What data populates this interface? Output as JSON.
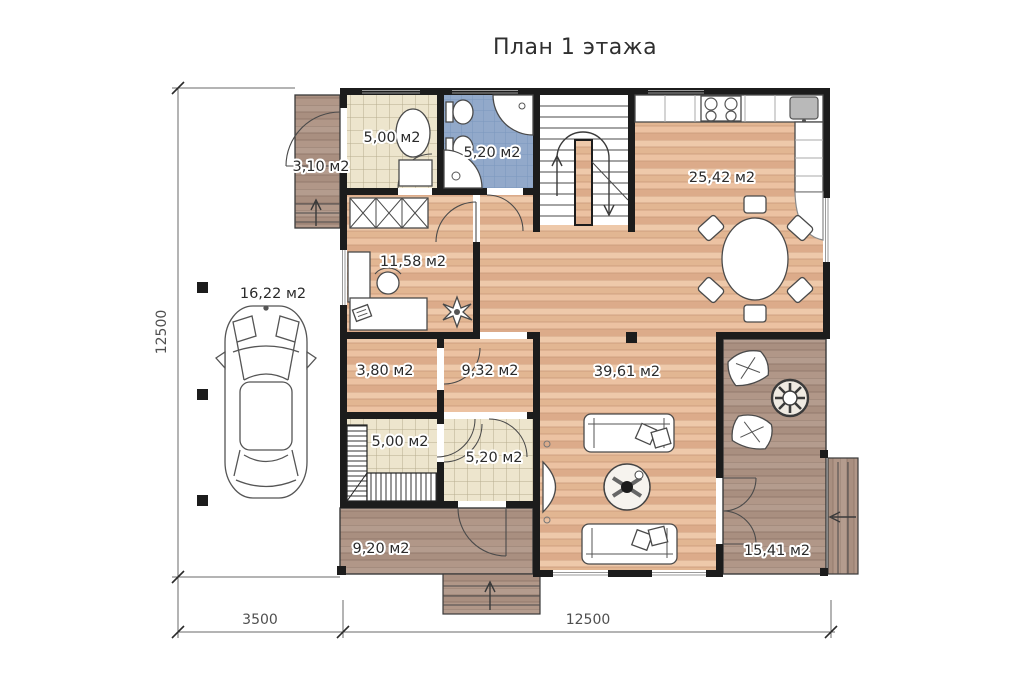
{
  "title": "План 1 этажа",
  "rooms": {
    "porch": "3,10 м2",
    "utility": "5,00 м2",
    "bathroom": "5,20 м2",
    "kitchen_dining": "25,42 м2",
    "office": "11,58 м2",
    "storage": "3,80 м2",
    "hallway": "9,32 м2",
    "boiler": "5,00 м2",
    "hall": "5,20 м2",
    "living": "39,61 м2",
    "terrace_back": "9,20 м2",
    "terrace_front": "15,41 м2",
    "carport": "16,22 м2"
  },
  "dimensions": {
    "total_depth": "12500",
    "carport_width": "3500",
    "house_width": "12500"
  },
  "colors": {
    "wall": "#1c1c1c",
    "wood_floor_light": "#eec9aa",
    "wood_floor_dark": "#dcab8a",
    "deck_light": "#b49c8e",
    "deck_dark": "#a98f80",
    "tile_beige": "#ede5cd",
    "tile_blue": "#92a9ca",
    "label_text": "#2b2b2b",
    "dimension_text": "#4f4f4f"
  }
}
